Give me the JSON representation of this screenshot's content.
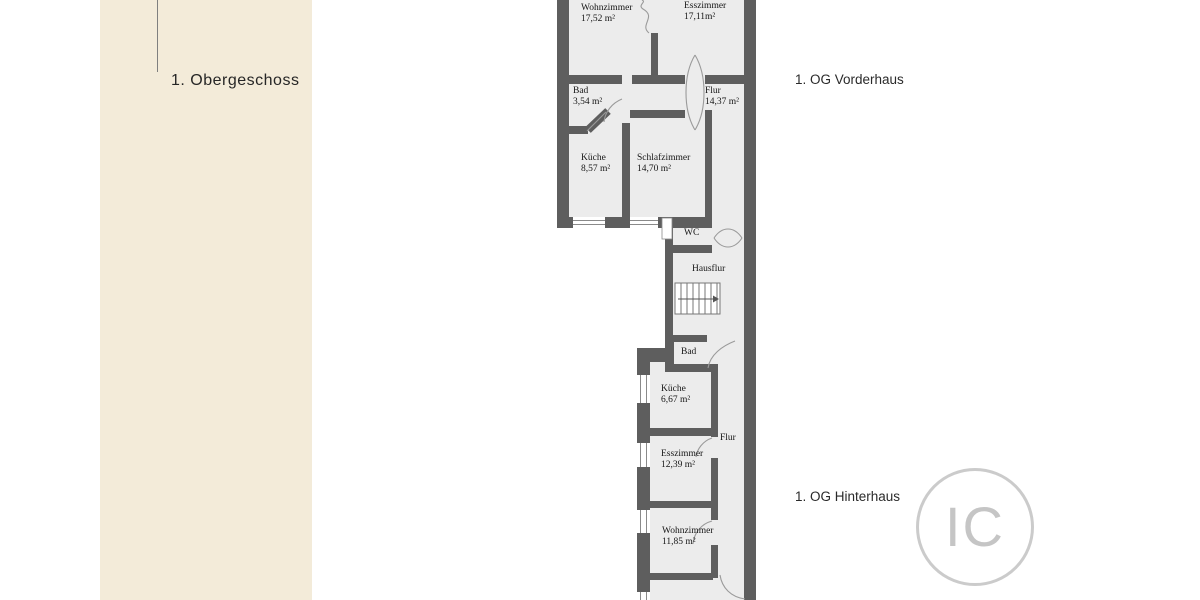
{
  "panel": {
    "title": "1. Obergeschoss"
  },
  "annotations": {
    "vorderhaus": "1. OG Vorderhaus",
    "hinterhaus": "1. OG Hinterhaus"
  },
  "plan": {
    "vorderhaus": {
      "rooms": [
        {
          "name": "Wohnzimmer",
          "area": "17,52 m²"
        },
        {
          "name": "Esszimmer",
          "area": "17,11m²"
        },
        {
          "name": "Bad",
          "area": "3,54 m²"
        },
        {
          "name": "Flur",
          "area": "14,37 m²"
        },
        {
          "name": "Küche",
          "area": "8,57 m²"
        },
        {
          "name": "Schlafzimmer",
          "area": "14,70 m²"
        }
      ]
    },
    "treppenhaus": {
      "rooms": [
        {
          "name": "WC"
        },
        {
          "name": "Hausflur"
        }
      ]
    },
    "hinterhaus": {
      "rooms": [
        {
          "name": "Bad"
        },
        {
          "name": "Küche",
          "area": "6,67 m²"
        },
        {
          "name": "Flur"
        },
        {
          "name": "Esszimmer",
          "area": "12,39 m²"
        },
        {
          "name": "Wohnzimmer",
          "area": "11,85 m²"
        }
      ]
    }
  },
  "watermark": {
    "text": "IC"
  },
  "colors": {
    "panel_beige": "#f3ebd9",
    "wall_gray": "#5e5e5e",
    "floor_gray": "#ececec",
    "watermark_gray": "#c5c5c5",
    "text_dark": "#1c1c1c"
  }
}
